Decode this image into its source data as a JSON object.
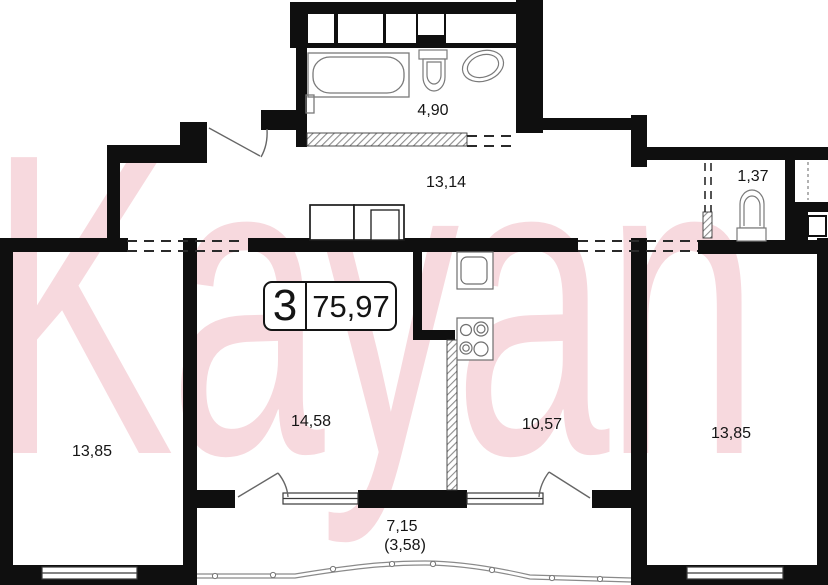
{
  "watermark": {
    "text": "Kayan",
    "color": "#f7d9de"
  },
  "unit": {
    "rooms_count": "3",
    "total_area": "75,97"
  },
  "rooms": [
    {
      "name": "bathroom",
      "area": "4,90"
    },
    {
      "name": "hallway",
      "area": "13,14"
    },
    {
      "name": "wc",
      "area": "1,37"
    },
    {
      "name": "room-left",
      "area": "13,85"
    },
    {
      "name": "room-middle",
      "area": "14,58"
    },
    {
      "name": "kitchen",
      "area": "10,57"
    },
    {
      "name": "room-right",
      "area": "13,85"
    },
    {
      "name": "balcony",
      "area": "7,15",
      "area_reduced": "(3,58)"
    }
  ],
  "colors": {
    "wall": "#0f0f0f",
    "fixture": "#7a7a7a",
    "watermark_pink": "#f7d9de"
  }
}
